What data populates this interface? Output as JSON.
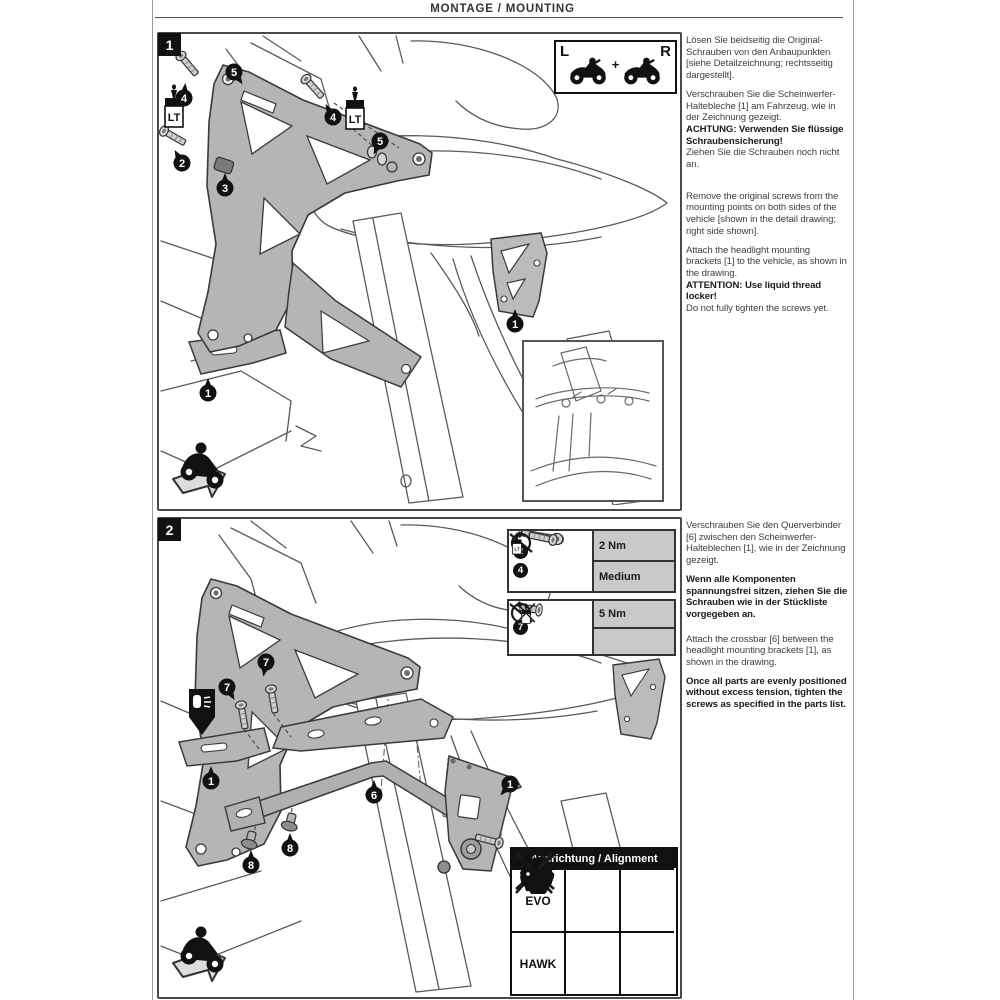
{
  "header": {
    "title": "MONTAGE / MOUNTING"
  },
  "instructions": {
    "step1": {
      "de": [
        "Lösen Sie beidseitig die Original-Schrauben von den Anbaupunkten [siehe Detailzeichnung; rechtsseitig dargestellt].",
        "Verschrauben Sie die Scheinwerfer-Haltebleche [1] am Fahrzeug, wie in der Zeichnung gezeigt.",
        "ACHTUNG: Verwenden Sie flüssige Schraubensicherung!",
        "Ziehen Sie die Schrauben noch nicht an."
      ],
      "en": [
        "Remove the original screws from the mounting points on both sides of the vehicle [shown in the detail drawing; right side shown].",
        "Attach the headlight mounting brackets [1] to the vehicle, as shown in the drawing.",
        "ATTENTION: Use liquid thread locker!",
        "Do not fully tighten the screws yet."
      ]
    },
    "step2": {
      "de": [
        "Verschrauben Sie den Querverbinder [6] zwischen den Scheinwerfer-Halteblechen [1], wie in der Zeichnung gezeigt.",
        "Wenn alle Komponenten spannungsfrei sitzen, ziehen Sie die Schrauben wie in der Stückliste vorgegeben an."
      ],
      "en": [
        "Attach the crossbar [6] between the headlight mounting brackets [1], as shown in the drawing.",
        "Once all parts are evenly positioned without excess tension, tighten the screws as specified in the parts list."
      ]
    }
  },
  "panel1": {
    "step_number": "1",
    "lr_box": {
      "left": "L",
      "right": "R",
      "plus": "+"
    }
  },
  "panel2": {
    "step_number": "2",
    "torque_box1": {
      "torque": "2 Nm",
      "threadlocker": "Medium"
    },
    "torque_box2": {
      "torque": "5 Nm"
    },
    "alignment": {
      "header": "Ausrichtung / Alignment",
      "rows": [
        "EVO",
        "HAWK"
      ]
    }
  },
  "callout_labels": {
    "n1": "1",
    "n2": "2",
    "n3": "3",
    "n4": "4",
    "n5": "5",
    "n6": "6",
    "n7": "7",
    "n8": "8"
  },
  "lt_label": "LT",
  "icons": [
    "torque-wrench-icon",
    "threadlocker-bottle-icon",
    "no-threadlocker-icon",
    "motorcycle-left-icon",
    "motorcycle-right-icon",
    "riding-direction-icon",
    "headlight-position-icon",
    "crossed-headlight-icon",
    "approved-headlight-icon"
  ],
  "colors": {
    "ink": "#111111",
    "line_gray": "#555555",
    "bracket_gray": "#b5b5b5",
    "cell_gray": "#c9c9c9"
  }
}
